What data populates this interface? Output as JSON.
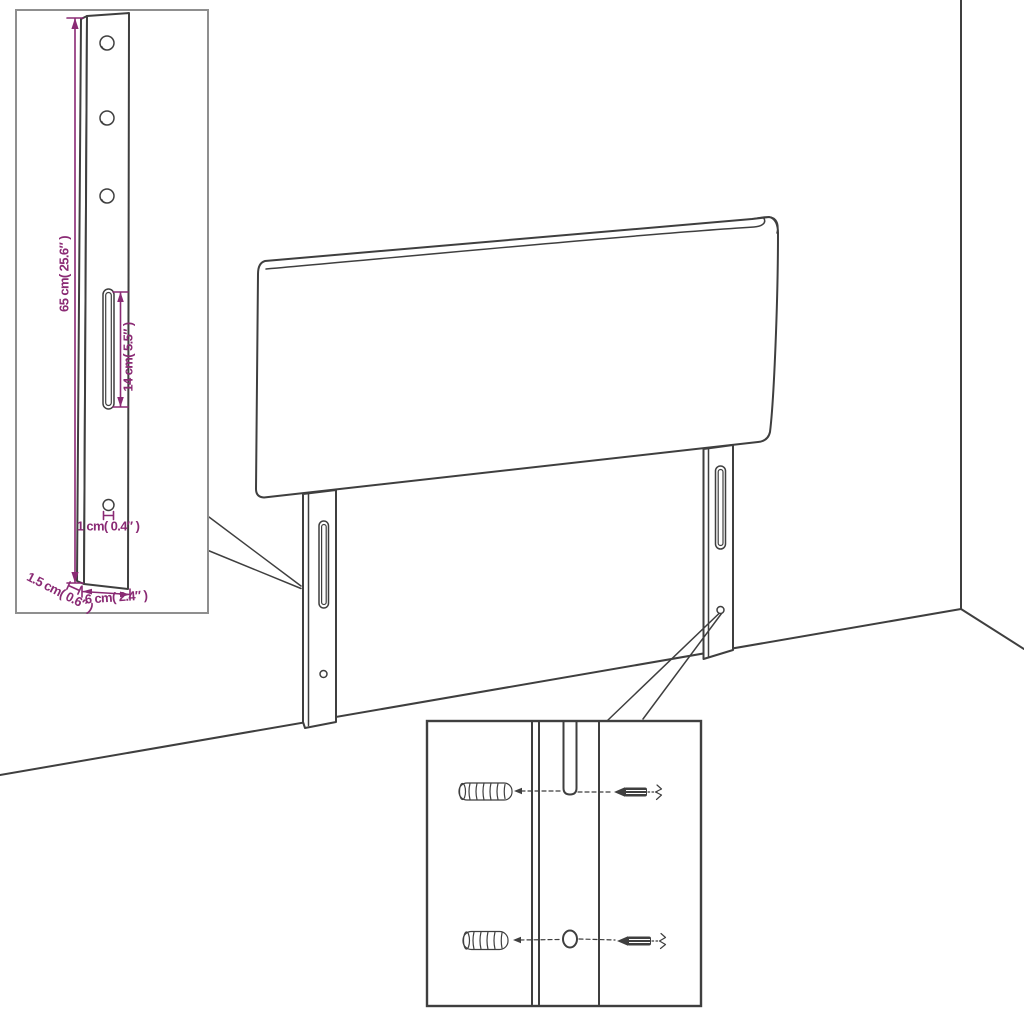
{
  "colors": {
    "background": "#ffffff",
    "line": "#3f3f3f",
    "inset_border": "#8f8f8f",
    "dimension": "#8a2a74"
  },
  "leg_dimensions": {
    "height": "65 cm( 25.6″ )",
    "slot_length": "14 cm( 5.5″ )",
    "hole_diameter": "1 cm( 0.4″ )",
    "thickness": "1.5 cm( 0.6″ )",
    "width": "6 cm( 2.4″ )"
  }
}
